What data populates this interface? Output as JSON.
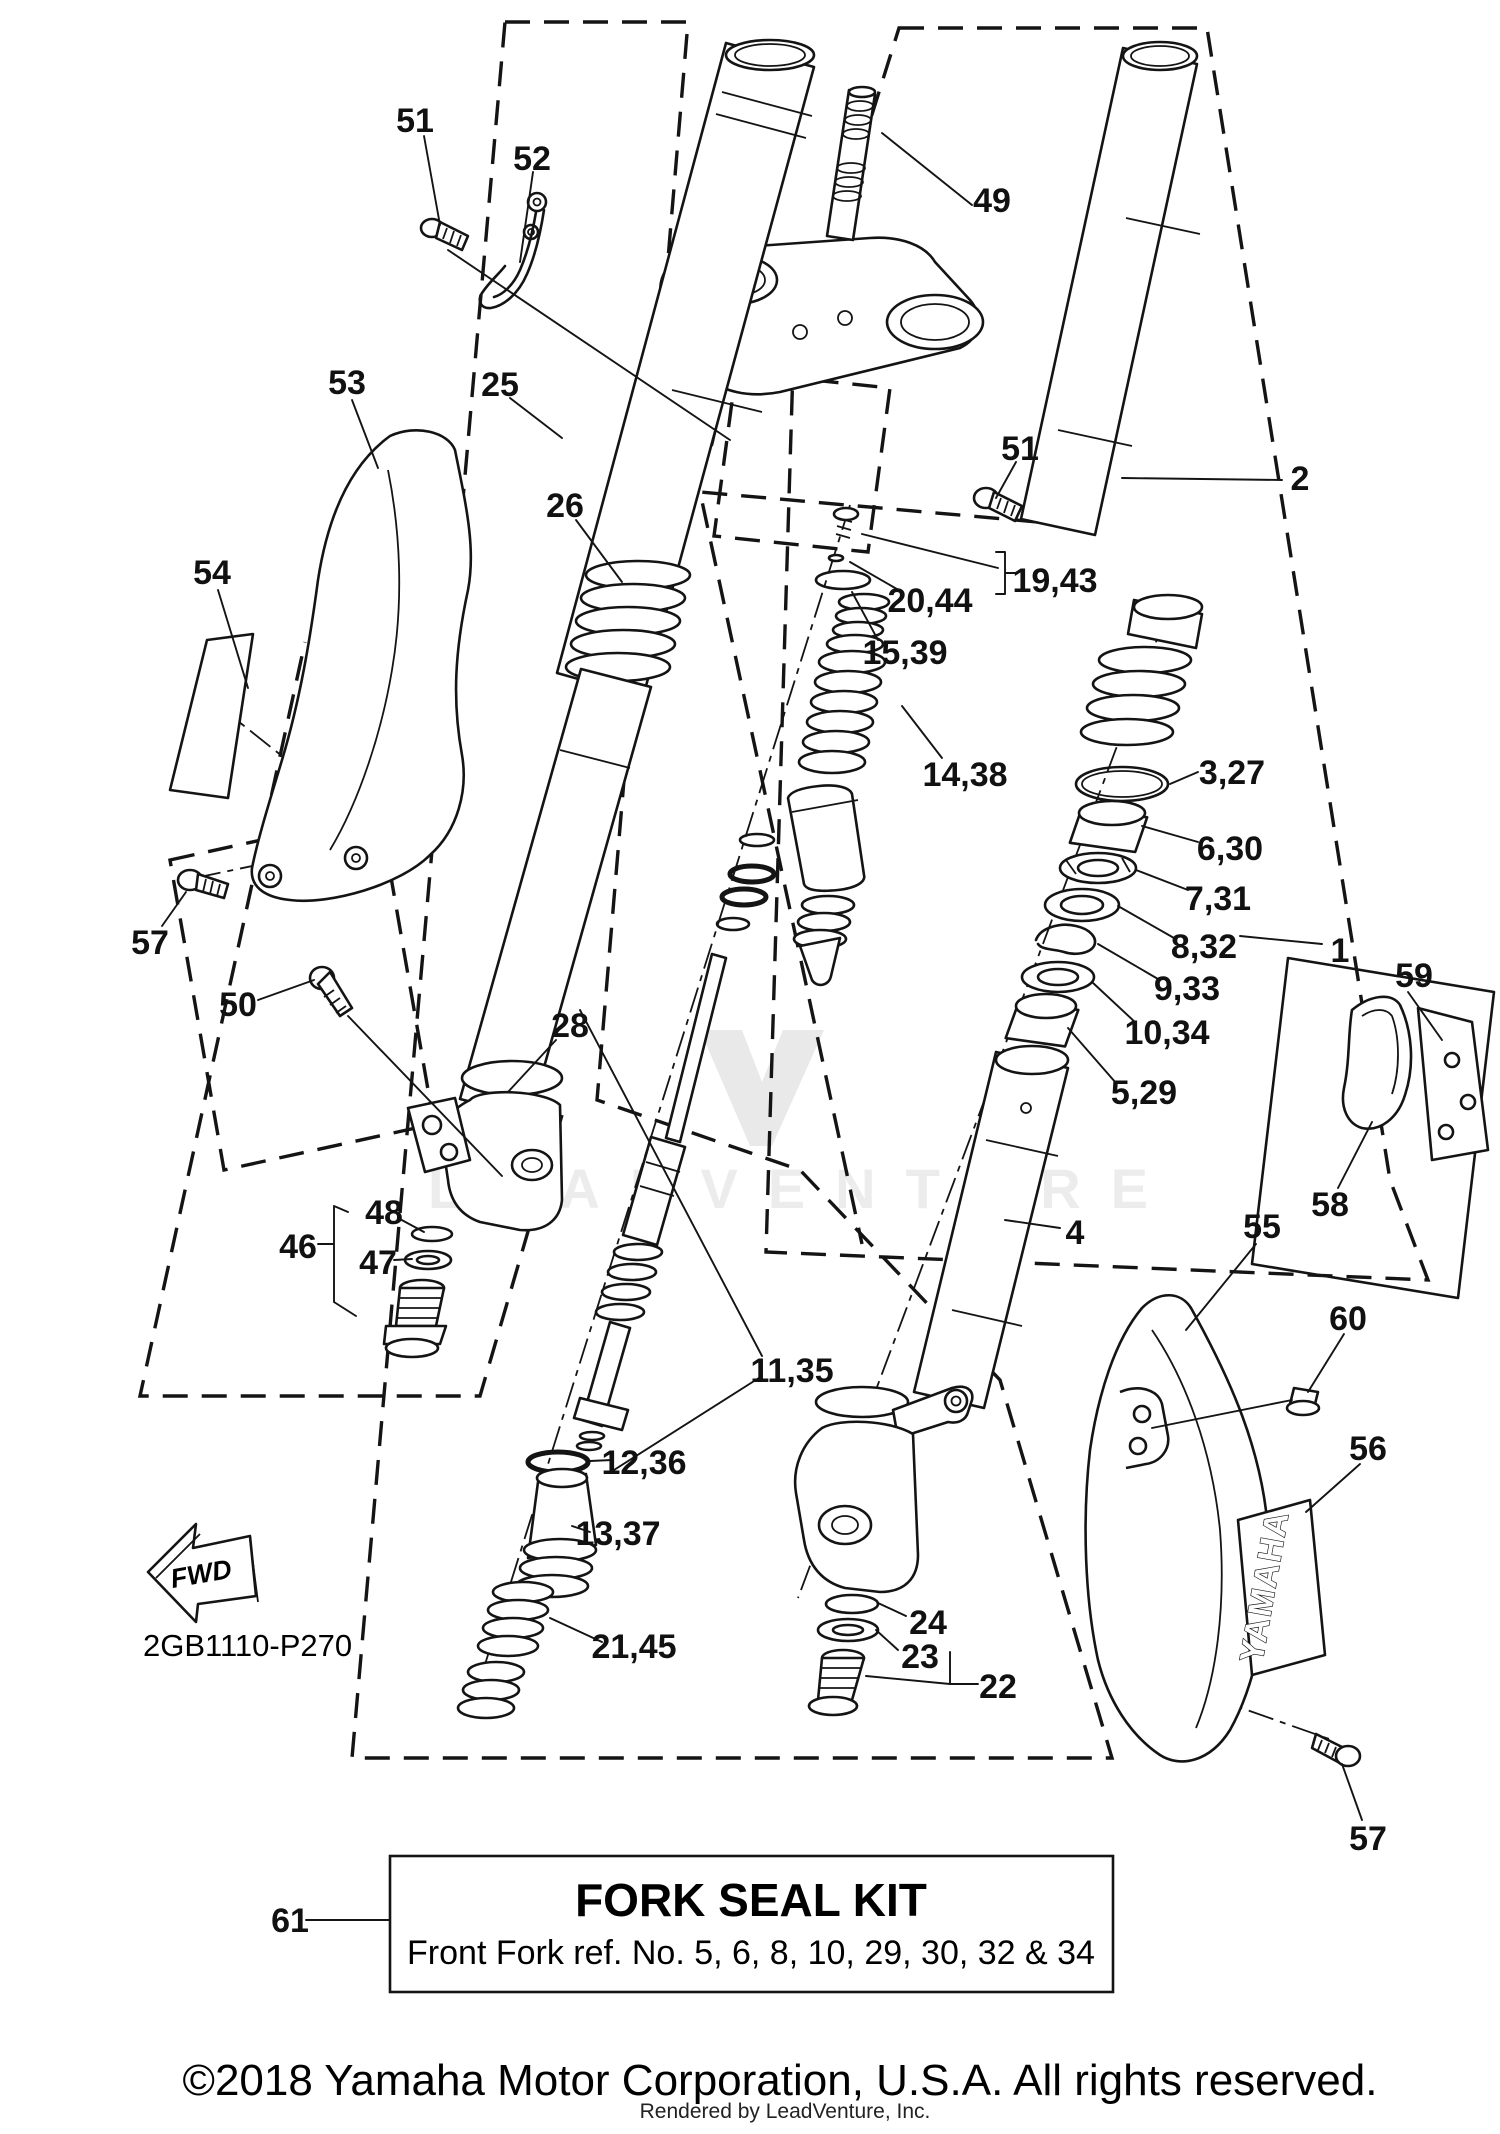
{
  "diagram": {
    "code": "2GB1110-P270",
    "fwd_label": "FWD",
    "decal_text": "YAMAHA",
    "watermark_text": "LEADVENTURE",
    "callouts": [
      {
        "id": "51-top",
        "text": "51",
        "x": 415,
        "y": 120
      },
      {
        "id": "52",
        "text": "52",
        "x": 532,
        "y": 158
      },
      {
        "id": "53",
        "text": "53",
        "x": 347,
        "y": 382
      },
      {
        "id": "54",
        "text": "54",
        "x": 212,
        "y": 572
      },
      {
        "id": "25",
        "text": "25",
        "x": 500,
        "y": 384
      },
      {
        "id": "26",
        "text": "26",
        "x": 565,
        "y": 505
      },
      {
        "id": "49",
        "text": "49",
        "x": 992,
        "y": 200
      },
      {
        "id": "2",
        "text": "2",
        "x": 1300,
        "y": 478
      },
      {
        "id": "51-mid",
        "text": "51",
        "x": 1020,
        "y": 448
      },
      {
        "id": "19-43",
        "text": "19,43",
        "x": 1055,
        "y": 580
      },
      {
        "id": "20-44",
        "text": "20,44",
        "x": 930,
        "y": 600
      },
      {
        "id": "15-39",
        "text": "15,39",
        "x": 905,
        "y": 652
      },
      {
        "id": "14-38",
        "text": "14,38",
        "x": 965,
        "y": 774
      },
      {
        "id": "3-27",
        "text": "3,27",
        "x": 1232,
        "y": 772
      },
      {
        "id": "6-30",
        "text": "6,30",
        "x": 1230,
        "y": 848
      },
      {
        "id": "7-31",
        "text": "7,31",
        "x": 1218,
        "y": 898
      },
      {
        "id": "8-32",
        "text": "8,32",
        "x": 1204,
        "y": 946
      },
      {
        "id": "9-33",
        "text": "9,33",
        "x": 1187,
        "y": 988
      },
      {
        "id": "10-34",
        "text": "10,34",
        "x": 1167,
        "y": 1032
      },
      {
        "id": "5-29",
        "text": "5,29",
        "x": 1144,
        "y": 1092
      },
      {
        "id": "1",
        "text": "1",
        "x": 1340,
        "y": 950
      },
      {
        "id": "59",
        "text": "59",
        "x": 1414,
        "y": 975
      },
      {
        "id": "58",
        "text": "58",
        "x": 1330,
        "y": 1204
      },
      {
        "id": "57-left",
        "text": "57",
        "x": 150,
        "y": 942
      },
      {
        "id": "50",
        "text": "50",
        "x": 238,
        "y": 1004
      },
      {
        "id": "28",
        "text": "28",
        "x": 570,
        "y": 1025
      },
      {
        "id": "4",
        "text": "4",
        "x": 1075,
        "y": 1232
      },
      {
        "id": "55",
        "text": "55",
        "x": 1262,
        "y": 1226
      },
      {
        "id": "46",
        "text": "46",
        "x": 298,
        "y": 1246
      },
      {
        "id": "48",
        "text": "48",
        "x": 384,
        "y": 1212
      },
      {
        "id": "47",
        "text": "47",
        "x": 378,
        "y": 1262
      },
      {
        "id": "60",
        "text": "60",
        "x": 1348,
        "y": 1318
      },
      {
        "id": "56",
        "text": "56",
        "x": 1368,
        "y": 1448
      },
      {
        "id": "11-35",
        "text": "11,35",
        "x": 792,
        "y": 1370
      },
      {
        "id": "12-36",
        "text": "12,36",
        "x": 644,
        "y": 1462
      },
      {
        "id": "13-37",
        "text": "13,37",
        "x": 618,
        "y": 1533
      },
      {
        "id": "21-45",
        "text": "21,45",
        "x": 634,
        "y": 1646
      },
      {
        "id": "24",
        "text": "24",
        "x": 928,
        "y": 1622
      },
      {
        "id": "23",
        "text": "23",
        "x": 920,
        "y": 1656
      },
      {
        "id": "22",
        "text": "22",
        "x": 998,
        "y": 1686
      },
      {
        "id": "61",
        "text": "61",
        "x": 290,
        "y": 1920
      },
      {
        "id": "57-bottom",
        "text": "57",
        "x": 1368,
        "y": 1838
      }
    ],
    "kit_box": {
      "ref_label": "61",
      "title": "FORK SEAL KIT",
      "subtitle": "Front Fork ref. No. 5, 6, 8, 10, 29, 30, 32 & 34"
    },
    "footer": {
      "copyright": "©2018 Yamaha Motor Corporation, U.S.A. All rights reserved.",
      "rendered_by": "Rendered by LeadVenture, Inc."
    }
  }
}
